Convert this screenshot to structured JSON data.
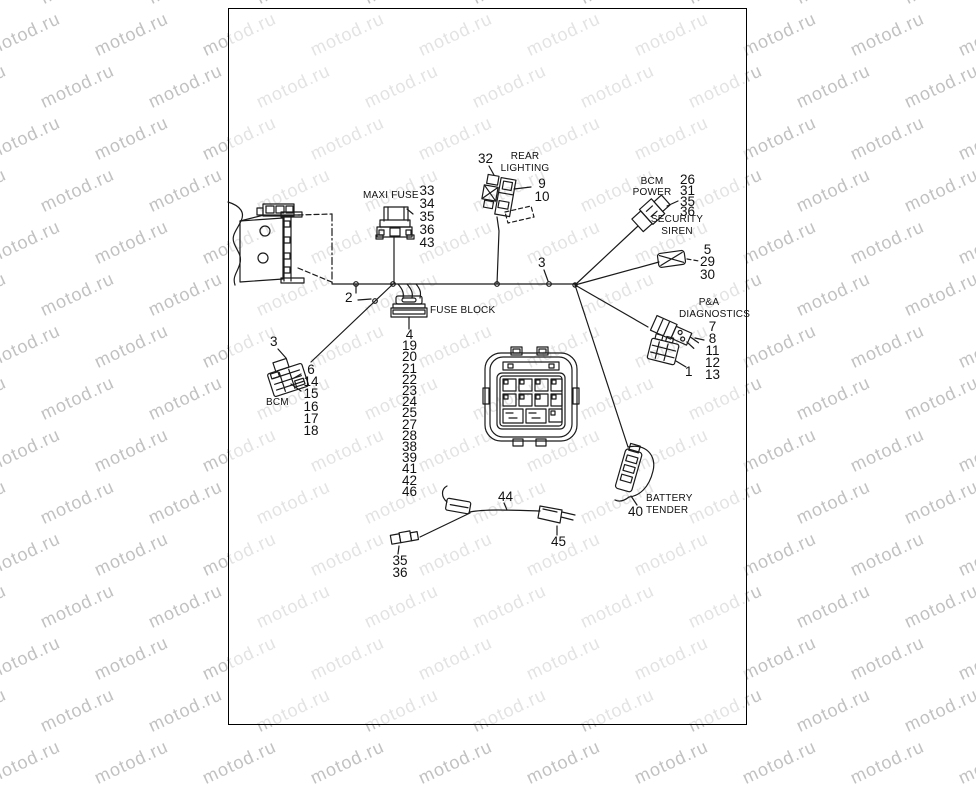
{
  "watermark": {
    "text": "motod.ru"
  },
  "labels": {
    "maxi_fuse": "MAXI FUSE",
    "fuse_block": "FUSE BLOCK",
    "bcm": "BCM",
    "rear_lighting": {
      "line1": "REAR",
      "line2": "LIGHTING"
    },
    "bcm_power": {
      "line1": "BCM",
      "line2": "POWER"
    },
    "security_siren": {
      "line1": "SECURITY",
      "line2": "SIREN"
    },
    "pa_diagnostics": {
      "line1": "P&A",
      "line2": "DIAGNOSTICS"
    },
    "battery_tender": {
      "line1": "BATTERY",
      "line2": "TENDER"
    }
  },
  "callouts": {
    "maxi_fuse": [
      "33",
      "34",
      "35",
      "36",
      "43"
    ],
    "rear_lighting_item": "32",
    "rear_lighting": [
      "9",
      "10"
    ],
    "spine_point": "3",
    "bcm_power": [
      "26",
      "31",
      "35",
      "36"
    ],
    "security_siren": [
      "5",
      "29",
      "30"
    ],
    "pa_diagnostics": [
      "7",
      "8",
      "11",
      "12",
      "13"
    ],
    "pa_connector": "1",
    "bcm_point": "3",
    "bcm": [
      "6",
      "14",
      "15",
      "16",
      "17",
      "18"
    ],
    "fuse_block": [
      "4",
      "19",
      "20",
      "21",
      "22",
      "23",
      "24",
      "25",
      "27",
      "28",
      "38",
      "39",
      "41",
      "42",
      "46"
    ],
    "harness_clip": "2",
    "jumper_wire": "44",
    "jumper_end": "45",
    "jumper_conn": [
      "35",
      "36"
    ],
    "battery_tender": "40"
  }
}
